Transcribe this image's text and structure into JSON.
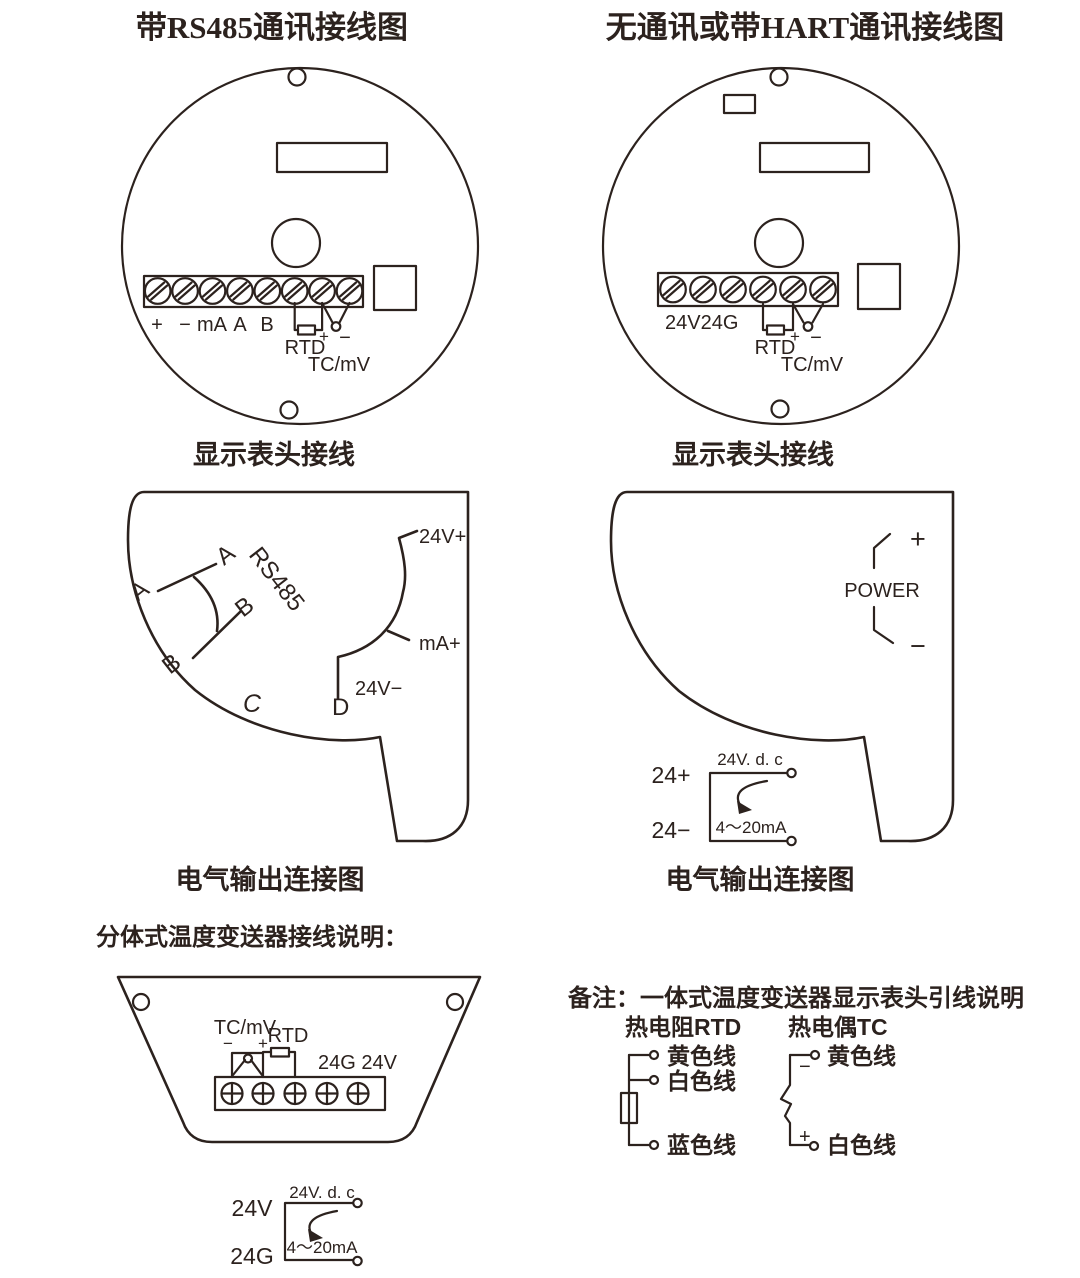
{
  "colors": {
    "ink": "#2c221e",
    "background": "#ffffff"
  },
  "titles": {
    "left": "带RS485通讯接线图",
    "right": "无通讯或带HART通讯接线图"
  },
  "captions": {
    "display_head_left": "显示表头接线",
    "display_head_right": "显示表头接线",
    "output_left": "电气输出连接图",
    "output_right": "电气输出连接图",
    "split_note": "分体式温度变送器接线说明：",
    "remark": "备注：一体式温度变送器显示表头引线说明"
  },
  "rs485_head": {
    "t1": "+",
    "t2": "−",
    "t3": "mA",
    "t4": "A",
    "t5": "B",
    "rtd": "RTD",
    "plus": "+",
    "minus": "−",
    "tc": "TC/mV"
  },
  "hart_head": {
    "power": "24V24G",
    "rtd": "RTD",
    "plus": "+",
    "minus": "−",
    "tc": "TC/mV"
  },
  "rs485_out": {
    "a1": "A",
    "a2": "A",
    "b1": "B",
    "b2": "B",
    "bus": "RS485",
    "c": "C",
    "d": "D",
    "v_plus": "24V+",
    "ma_plus": "mA+",
    "v_minus": "24V−"
  },
  "hart_out": {
    "plus": "+",
    "minus": "−",
    "power": "POWER",
    "supply": "24V. d. c",
    "p": "24+",
    "n": "24−",
    "loop": "4～20mA"
  },
  "split_head": {
    "tc": "TC/mV",
    "rtd": "RTD",
    "minus": "−",
    "plus": "+",
    "power": "24G 24V",
    "supply": "24V. d. c",
    "v": "24V",
    "g": "24G",
    "loop": "4～20mA"
  },
  "leads": {
    "rtd_title": "热电阻RTD",
    "tc_title": "热电偶TC",
    "rtd_wire1": "黄色线",
    "rtd_wire2": "白色线",
    "rtd_wire3": "蓝色线",
    "tc_minus": "−",
    "tc_plus": "+",
    "tc_wire1": "黄色线",
    "tc_wire2": "白色线"
  }
}
